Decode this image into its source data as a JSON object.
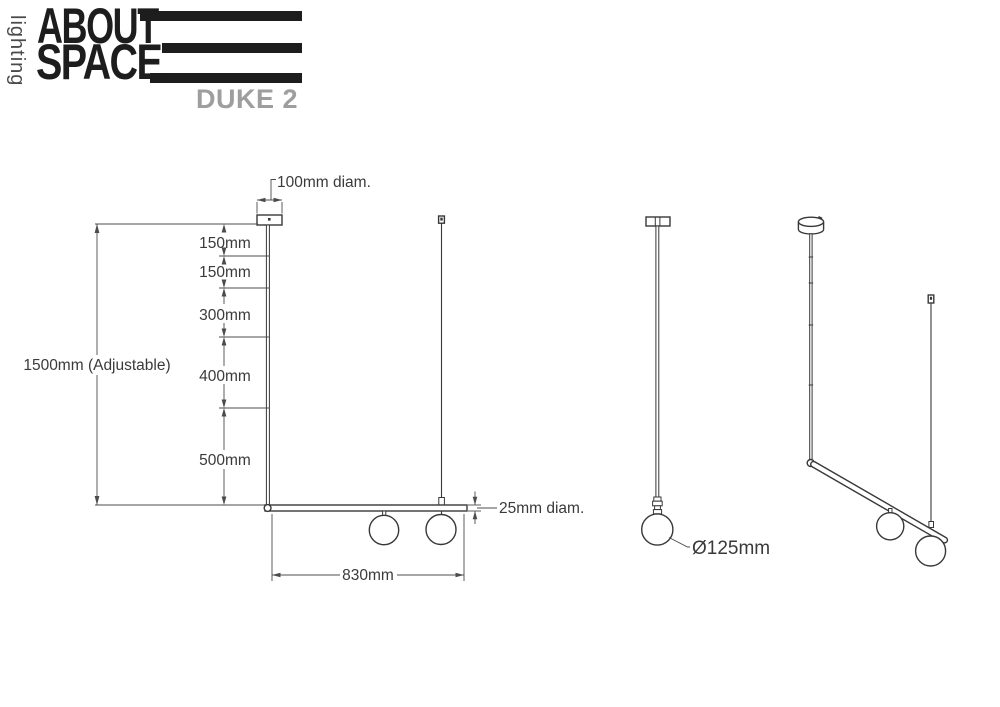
{
  "logo": {
    "vertical_text": "lighting",
    "word1": "ABOUT",
    "word2": "SPACE"
  },
  "product_title": "DUKE 2",
  "front_view": {
    "canopy_diameter": "100mm diam.",
    "overall_height": "1500mm (Adjustable)",
    "segments": [
      "150mm",
      "150mm",
      "300mm",
      "400mm",
      "500mm"
    ],
    "bar_length": "830mm",
    "bar_diameter": "25mm diam."
  },
  "side_view": {
    "sphere_diameter": "Ø125mm"
  },
  "colors": {
    "line": "#383838",
    "dimension": "#4c4c4c",
    "text": "#3a3a3a",
    "logo_black": "#1d1d1d",
    "title_gray": "#9e9e9e"
  }
}
